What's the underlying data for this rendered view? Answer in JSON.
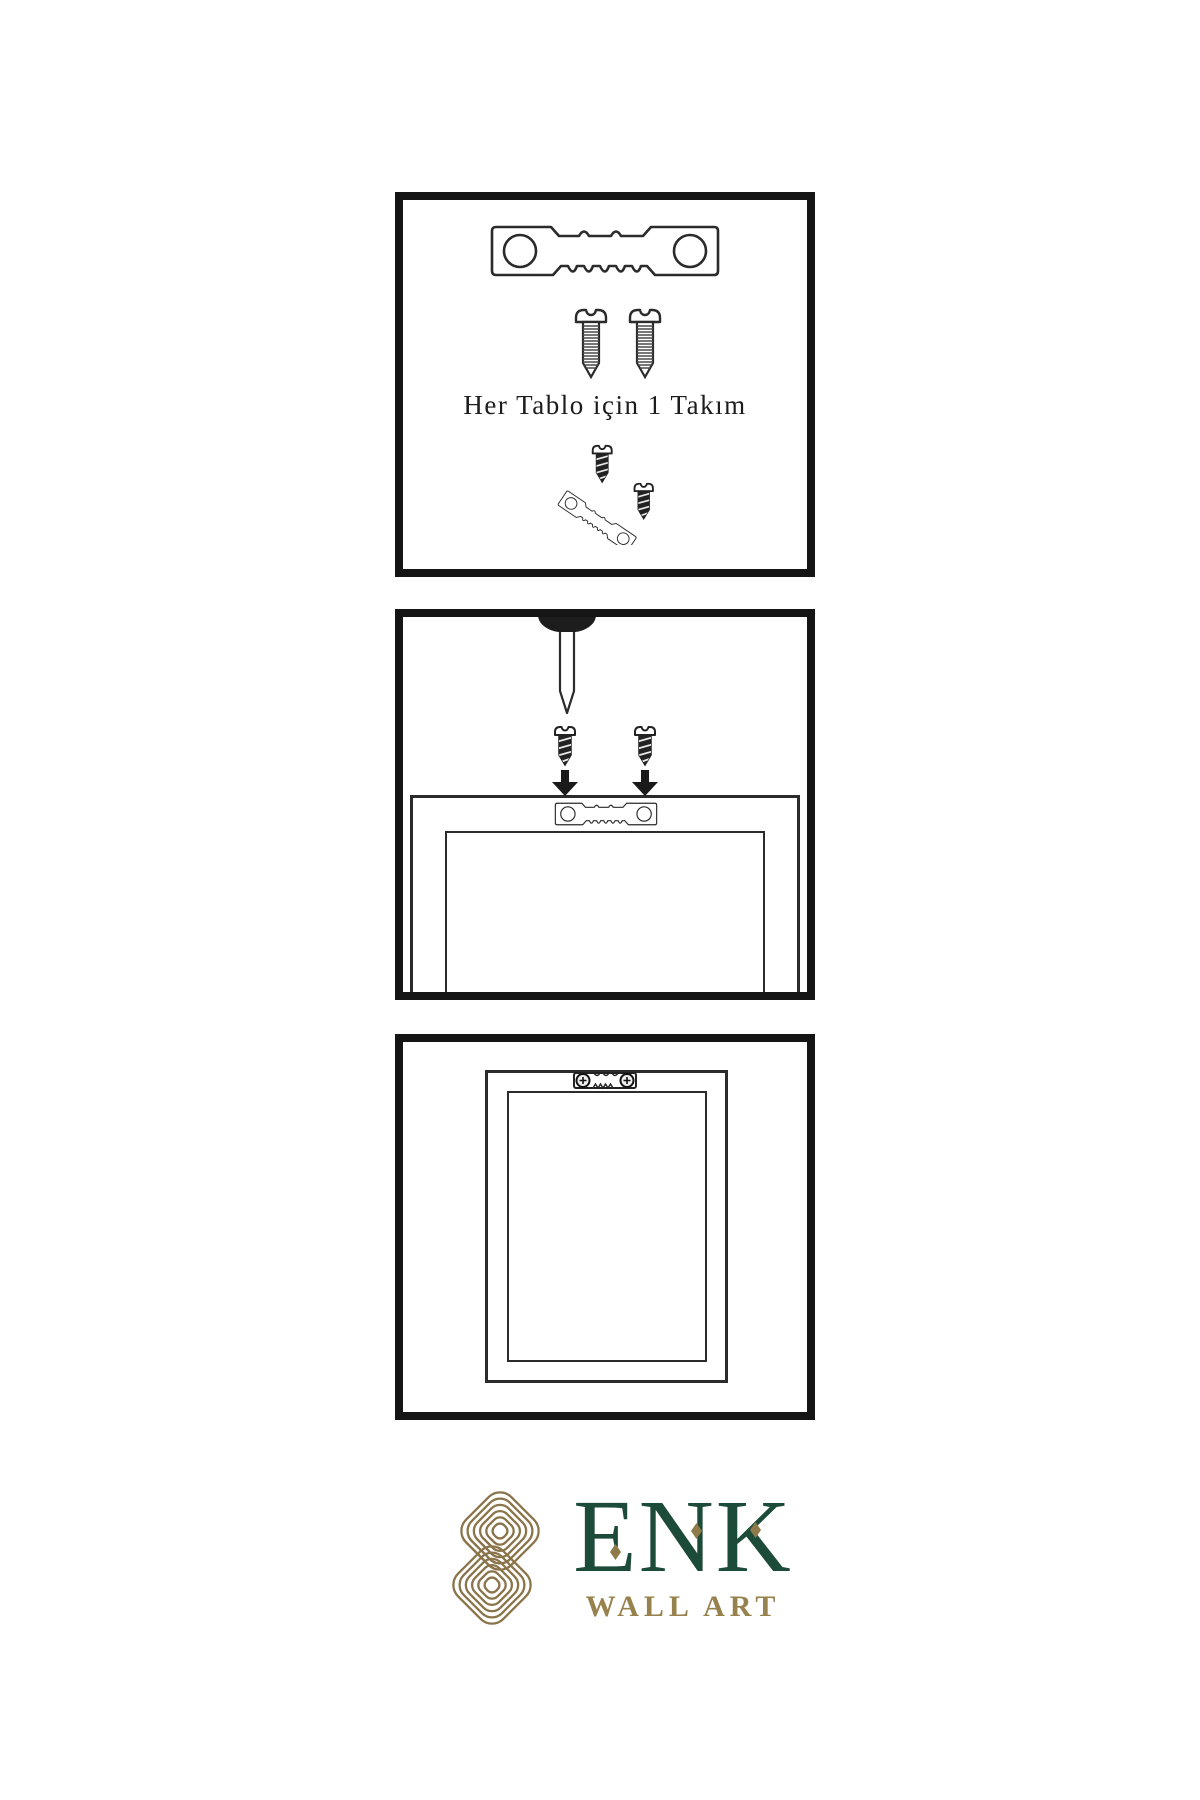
{
  "document": {
    "background": "#ffffff",
    "type": "hanging-instructions-sheet"
  },
  "colors": {
    "panel_border": "#151515",
    "line_ink": "#2b2b2b",
    "dark_fill": "#1f1f1f",
    "logo_green": "#1d4b3a",
    "logo_gold": "#8f7a4a",
    "logo_gold_light": "#97824d"
  },
  "panels": {
    "kit": {
      "caption": "Her Tablo için 1 Takım",
      "icons": [
        "sawtooth-hanger",
        "screw",
        "screw",
        "screw-into-hanger"
      ]
    },
    "nail": {
      "icons": [
        "wall-nail",
        "screw",
        "screw",
        "arrow-down",
        "arrow-down",
        "sawtooth-hanger-on-frame"
      ]
    },
    "hung": {
      "icons": [
        "installed-hanger-on-frame"
      ]
    }
  },
  "logo": {
    "mark": "interlocked-knot",
    "wordmark": "ENK",
    "subtitle": "WALL ART"
  }
}
